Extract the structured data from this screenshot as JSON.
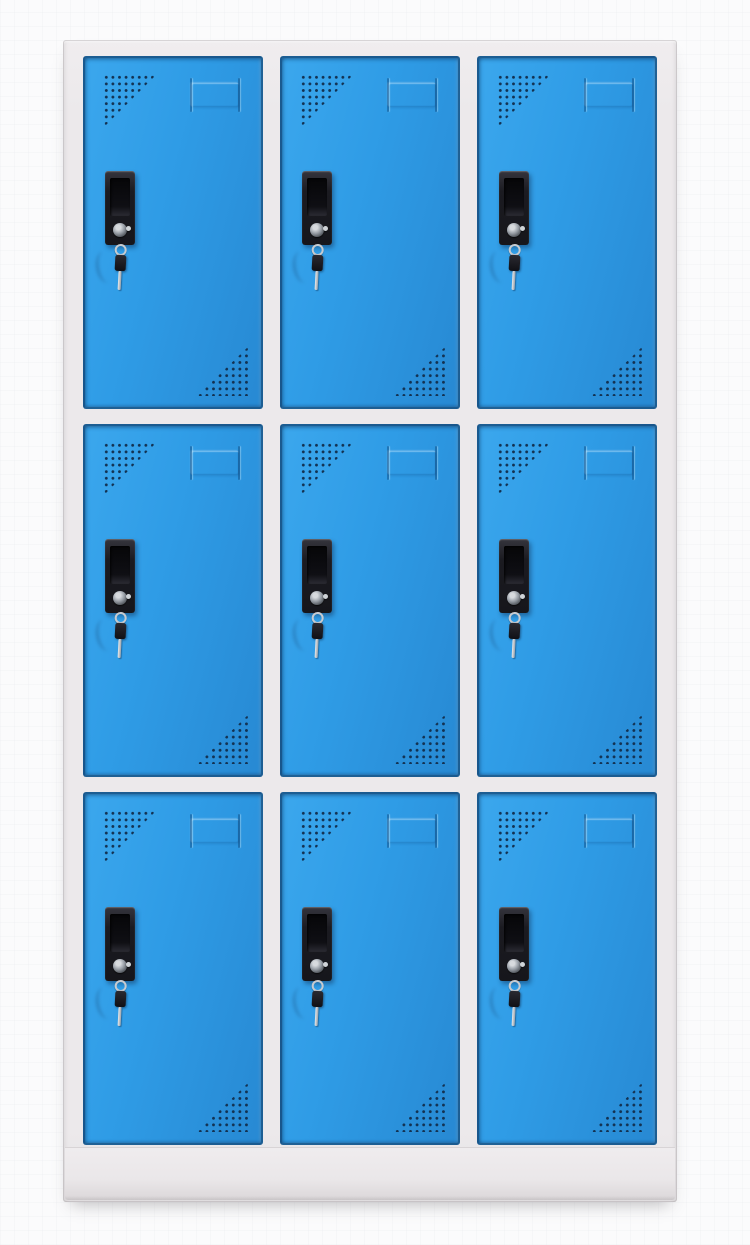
{
  "scene": {
    "description": "Product photograph of a nine-door steel locker cabinet on a plain white background",
    "object": "9-door locker cabinet",
    "orientation": "front view, full height"
  },
  "colors": {
    "door_blue": "#2F9CE6",
    "door_blue_light": "#3BA7ED",
    "door_blue_dark": "#2789D3",
    "door_edge": "#10375F",
    "frame_gray": "#ECE9EB",
    "frame_edge": "#D8D4D6",
    "base_shadow": "#C9C5C7",
    "vent_dot": "#133252",
    "handle_black": "#1B1B21",
    "key_silver": "#C7CBD0",
    "background": "#FBFBFC"
  },
  "cabinet": {
    "rows": 3,
    "columns": 3,
    "door_count": 9,
    "frame": "light gray steel frame with bottom plinth base",
    "doors": [
      {
        "row": 1,
        "col": 1
      },
      {
        "row": 1,
        "col": 2
      },
      {
        "row": 1,
        "col": 3
      },
      {
        "row": 2,
        "col": 1
      },
      {
        "row": 2,
        "col": 2
      },
      {
        "row": 2,
        "col": 3
      },
      {
        "row": 3,
        "col": 1
      },
      {
        "row": 3,
        "col": 2
      },
      {
        "row": 3,
        "col": 3
      }
    ],
    "door_features": [
      "perforated vent triangle top-left",
      "embossed name-card slot upper-center-right",
      "black recessed grip handle with lock cylinder",
      "key hanging from lock on key ring",
      "perforated vent triangle bottom-right"
    ]
  }
}
